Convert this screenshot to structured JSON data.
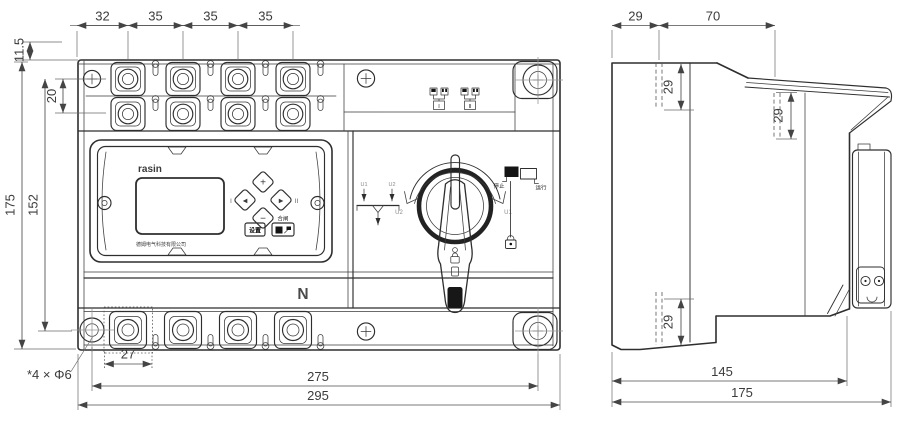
{
  "front": {
    "dims": {
      "pitch": [
        "32",
        "35",
        "35",
        "35"
      ],
      "edge_offset": "11.5",
      "row_gap": "20",
      "height": "175",
      "hole_height": "152",
      "terminal_width": "27",
      "hole_span": "275",
      "width": "295"
    },
    "mounting_note": "*4 × Φ6",
    "neutral_label": "N",
    "indicators": {
      "source1": "I",
      "source2": "II"
    },
    "panel": {
      "brand": "rasin",
      "company": "德姆电气科技有限公司",
      "keys": {
        "up": "+",
        "down": "−",
        "left": "◀",
        "right": "▶",
        "marker_left": "I",
        "marker_right": "II"
      },
      "buttons": {
        "settings": "设置",
        "close": "合闸"
      }
    },
    "switch": {
      "arrow_left": "U2",
      "arrow_right": "U1",
      "schematic": {
        "source_left": "U1",
        "source_right": "U2"
      },
      "legend": {
        "stop": "停止",
        "run": "运行"
      }
    }
  },
  "side": {
    "dims": {
      "rear_depth": "29",
      "top_width": "70",
      "step_top": "29",
      "step_front": "29",
      "step_bottom": "29",
      "body_depth": "145",
      "total_depth": "175"
    }
  }
}
